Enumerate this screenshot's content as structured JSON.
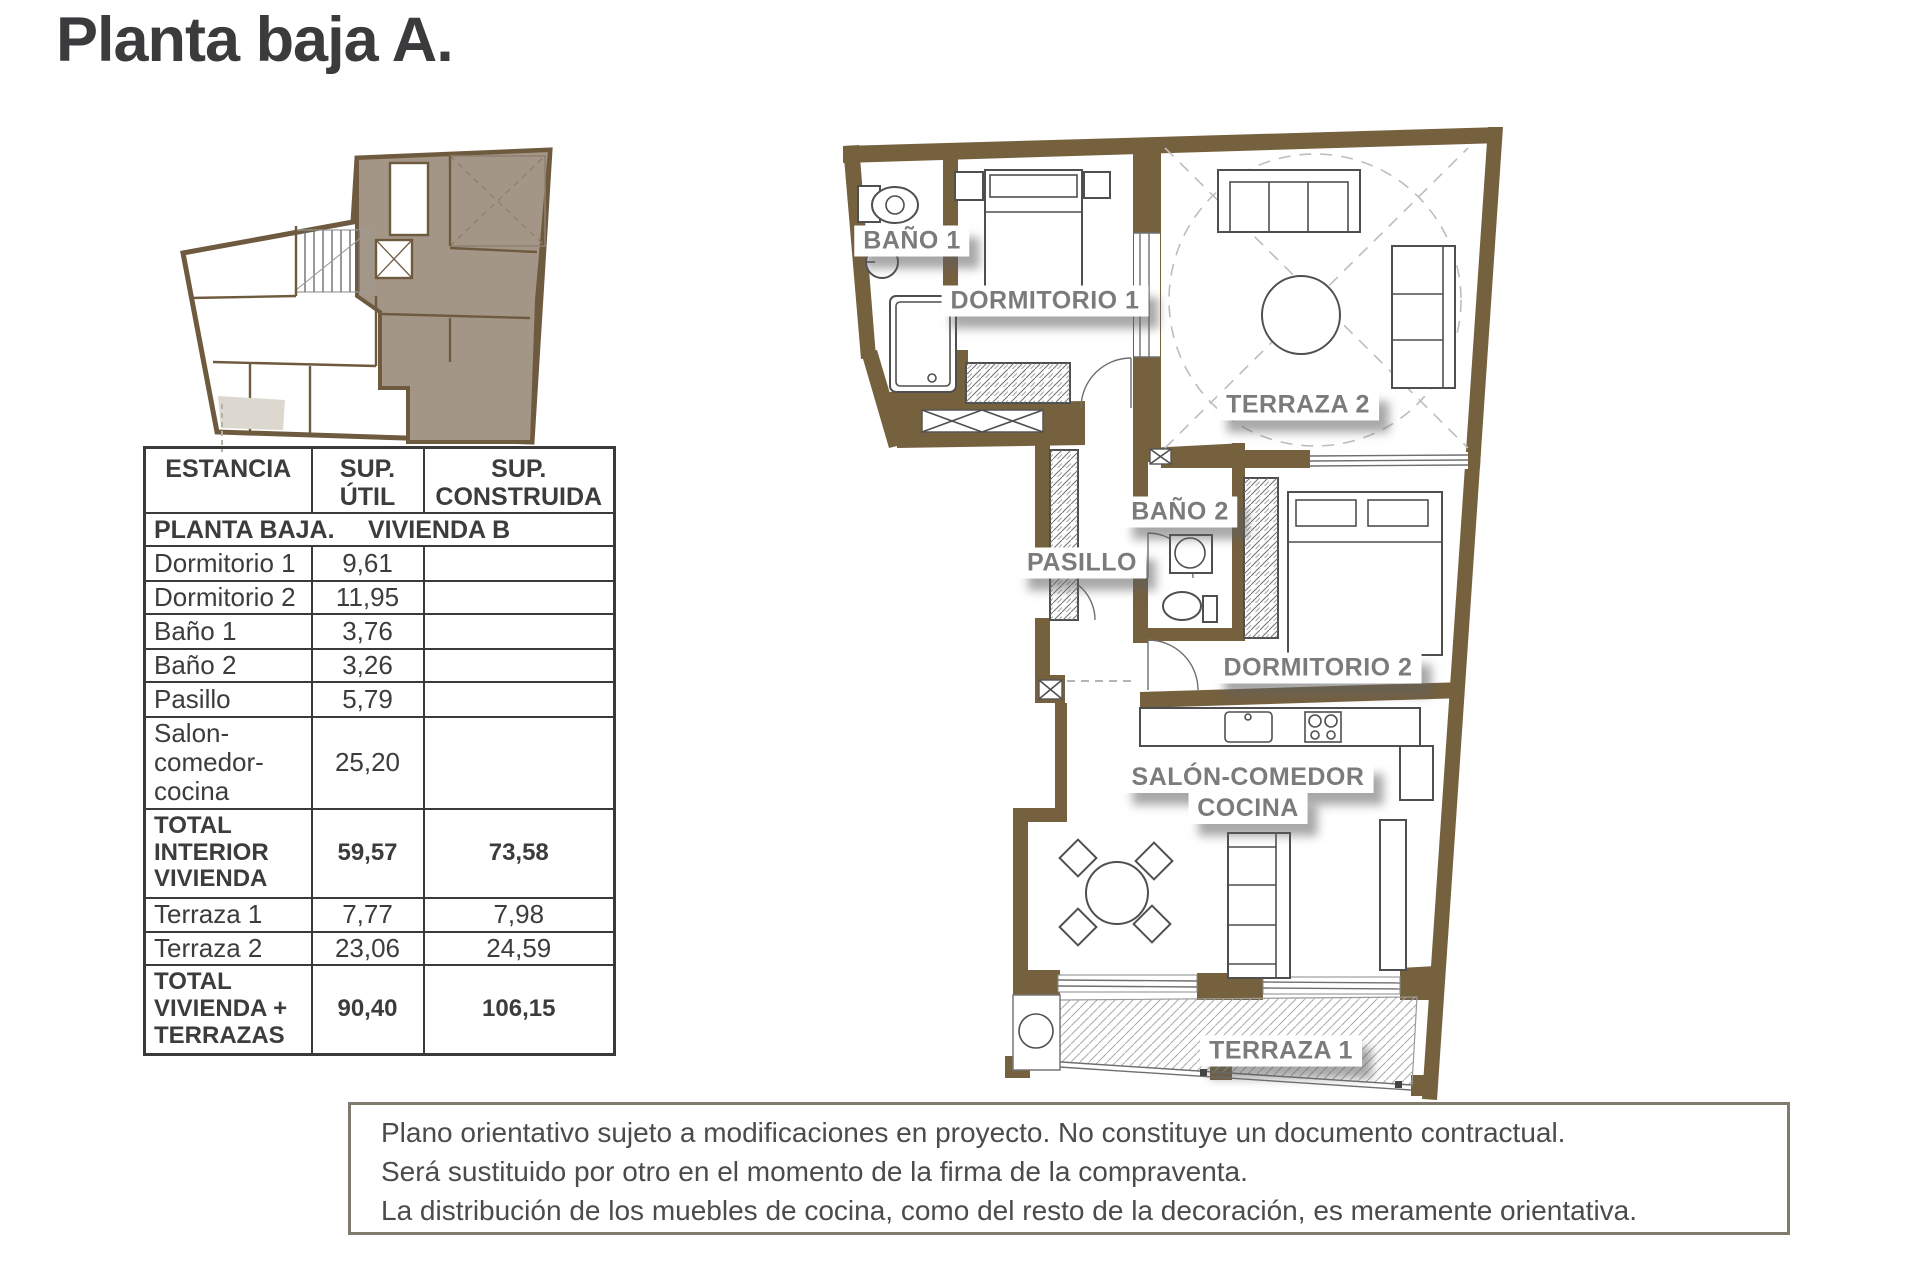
{
  "title": "Planta baja A.",
  "table": {
    "headers": [
      "ESTANCIA",
      "SUP. ÚTIL",
      "SUP. CONSTRUIDA"
    ],
    "section": {
      "left": "PLANTA BAJA.",
      "right": "VIVIENDA B"
    },
    "rows": [
      {
        "name": "Dormitorio 1",
        "util": "9,61",
        "built": ""
      },
      {
        "name": "Dormitorio 2",
        "util": "11,95",
        "built": ""
      },
      {
        "name": "Baño 1",
        "util": "3,76",
        "built": ""
      },
      {
        "name": "Baño 2",
        "util": "3,26",
        "built": ""
      },
      {
        "name": "Pasillo",
        "util": "5,79",
        "built": ""
      },
      {
        "name": "Salon-comedor-cocina",
        "util": "25,20",
        "built": ""
      },
      {
        "name": "TOTAL INTERIOR VIVIENDA",
        "util": "59,57",
        "built": "73,58"
      },
      {
        "name": "Terraza 1",
        "util": "7,77",
        "built": "7,98"
      },
      {
        "name": "Terraza 2",
        "util": "23,06",
        "built": "24,59"
      },
      {
        "name": "TOTAL VIVIENDA + TERRAZAS",
        "util": "90,40",
        "built": "106,15"
      }
    ]
  },
  "plan_labels": {
    "bano1": "BAÑO 1",
    "dormitorio1": "DORMITORIO 1",
    "terraza2": "TERRAZA 2",
    "bano2": "BAÑO 2",
    "pasillo": "PASILLO",
    "dormitorio2": "DORMITORIO 2",
    "salon_line1": "SALÓN-COMEDOR",
    "salon_line2": "COCINA",
    "terraza1": "TERRAZA 1"
  },
  "disclaimer": {
    "line1": "Plano orientativo sujeto a modificaciones en proyecto. No constituye un documento contractual.",
    "line2": "Será sustituido por otro en el momento de la firma de la compraventa.",
    "line3": "La distribución de los muebles de cocina, como del resto de la decoración, es meramente orientativa."
  },
  "colors": {
    "wall": "#76613F",
    "unit_fill": "#A49686",
    "label_text": "#7B7B7B",
    "table_border": "#3A3A3A"
  }
}
